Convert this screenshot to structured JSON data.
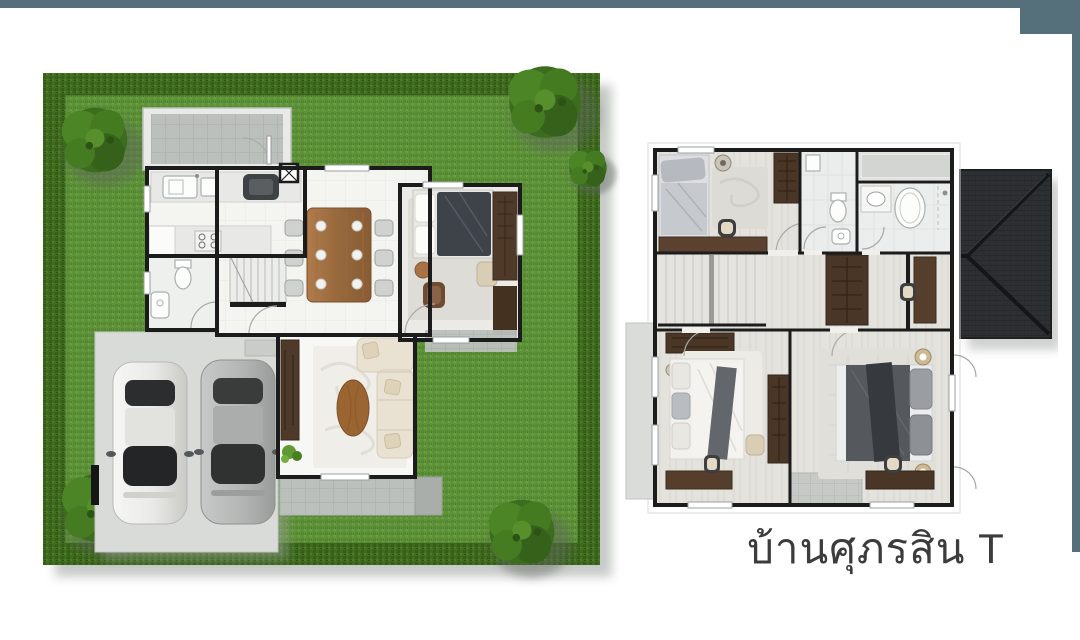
{
  "title": {
    "label": "บ้านศุภรสิน T"
  },
  "plans": {
    "ground_floor": {
      "name": "ground-floor-plan",
      "elements": [
        "garden-lawn",
        "hedge-border",
        "trees",
        "driveway",
        "car-silver",
        "car-gray",
        "laundry-terrace",
        "kitchen-counters",
        "sink",
        "stove",
        "island-fridge",
        "bathroom-toilet-basin",
        "staircase",
        "entry-door-mat",
        "dining-table-6-chairs",
        "service-column",
        "bedroom-bed",
        "armchair",
        "wardrobe",
        "tv-cabinet",
        "living-sofa-L",
        "coffee-table",
        "rug",
        "plant",
        "rear-tile-terrace",
        "side-tile-terrace"
      ]
    },
    "upper_floor": {
      "name": "upper-floor-plan",
      "elements": [
        "bedroom-2-single-bed",
        "desk-chair",
        "wardrobe",
        "bathroom-1-toilet-basin",
        "bathroom-2-vanity-tub-shower",
        "balcony-ledge",
        "staircase",
        "hall-cabinet",
        "dressing-desk",
        "bedroom-3-double-bed",
        "master-bedroom-double-bed",
        "nightstand-lamps",
        "side-balcony",
        "rear-tile-balcony",
        "hip-roof"
      ]
    }
  },
  "counts": {
    "cars": 2,
    "ground_floor_bedrooms": 1,
    "upper_floor_bedrooms": 3,
    "upper_floor_bathrooms": 2
  },
  "colors": {
    "slate": "#56707b",
    "text": "#3c3c3c",
    "wall": "#1c1c1c",
    "grass": "#5f9339",
    "hedge": "#406c20",
    "tree": "#3c6c1d",
    "concrete": "#d9dbd8",
    "tile": "#bcc0bc",
    "floor": "#f4f4f1",
    "floor-upper": "#e3e2dd",
    "wood": "#9a6632",
    "wood-dark": "#4a3626",
    "sofa": "#e9e2d2",
    "duvet-dark": "#3e4249",
    "master-duvet": "#55585c",
    "roof": "#2d3032",
    "car-silver": "#efefec",
    "car-gray": "#b6b9b7"
  }
}
